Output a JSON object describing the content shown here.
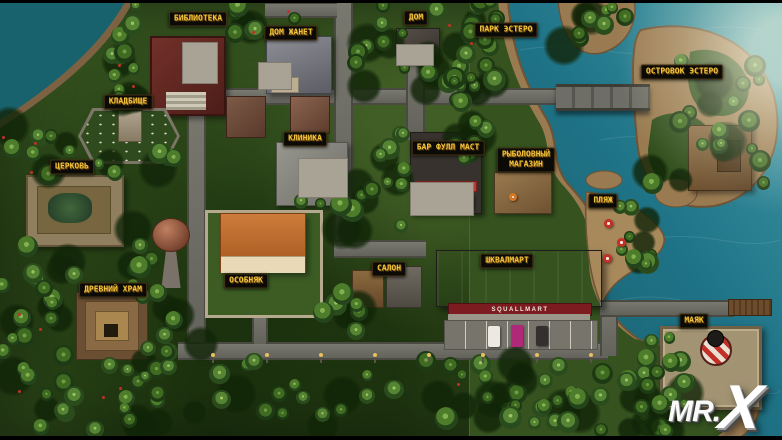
{
  "map": {
    "locations": [
      {
        "id": "library",
        "text": "БИБЛИОТЕКА",
        "x": 198,
        "y": 19
      },
      {
        "id": "janet-house",
        "text": "ДОМ ЖАНЕТ",
        "x": 291,
        "y": 33
      },
      {
        "id": "house",
        "text": "ДОМ",
        "x": 416,
        "y": 18
      },
      {
        "id": "park-estero",
        "text": "ПАРК ЭСТЕРО",
        "x": 506,
        "y": 30
      },
      {
        "id": "islet-estero",
        "text": "ОСТРОВОК ЭСТЕРО",
        "x": 682,
        "y": 72
      },
      {
        "id": "cemetery",
        "text": "КЛАДБИЩЕ",
        "x": 128,
        "y": 102
      },
      {
        "id": "clinic",
        "text": "КЛИНИКА",
        "x": 305,
        "y": 139
      },
      {
        "id": "bar-full-mast",
        "text": "БАР ФУЛЛ МАСТ",
        "x": 448,
        "y": 148
      },
      {
        "id": "fishing-shop",
        "text": "РЫБОЛОВНЫЙ\nМАГАЗИН",
        "x": 526,
        "y": 160
      },
      {
        "id": "church",
        "text": "ЦЕРКОВЬ",
        "x": 72,
        "y": 167
      },
      {
        "id": "beach",
        "text": "ПЛЯЖ",
        "x": 603,
        "y": 201
      },
      {
        "id": "squallmart",
        "text": "ШКВАЛМАРТ",
        "x": 507,
        "y": 261
      },
      {
        "id": "salon",
        "text": "САЛОН",
        "x": 389,
        "y": 269
      },
      {
        "id": "mansion",
        "text": "ОСОБНЯК",
        "x": 246,
        "y": 281
      },
      {
        "id": "ancient-temple",
        "text": "ДРЕВНИЙ ХРАМ",
        "x": 113,
        "y": 290
      },
      {
        "id": "lighthouse",
        "text": "МАЯК",
        "x": 694,
        "y": 321
      }
    ],
    "storefront_sign": "SQUALLMART",
    "logo": {
      "prefix": "MR.",
      "x_letter": "X"
    },
    "colors": {
      "label_text": "#f3c53d",
      "label_bg": "#0c0a06",
      "ocean": "#1f7386",
      "jungle": "#35521f",
      "sand": "#9a7b51",
      "road": "#6e6e68",
      "accent_red": "#c23028"
    }
  }
}
